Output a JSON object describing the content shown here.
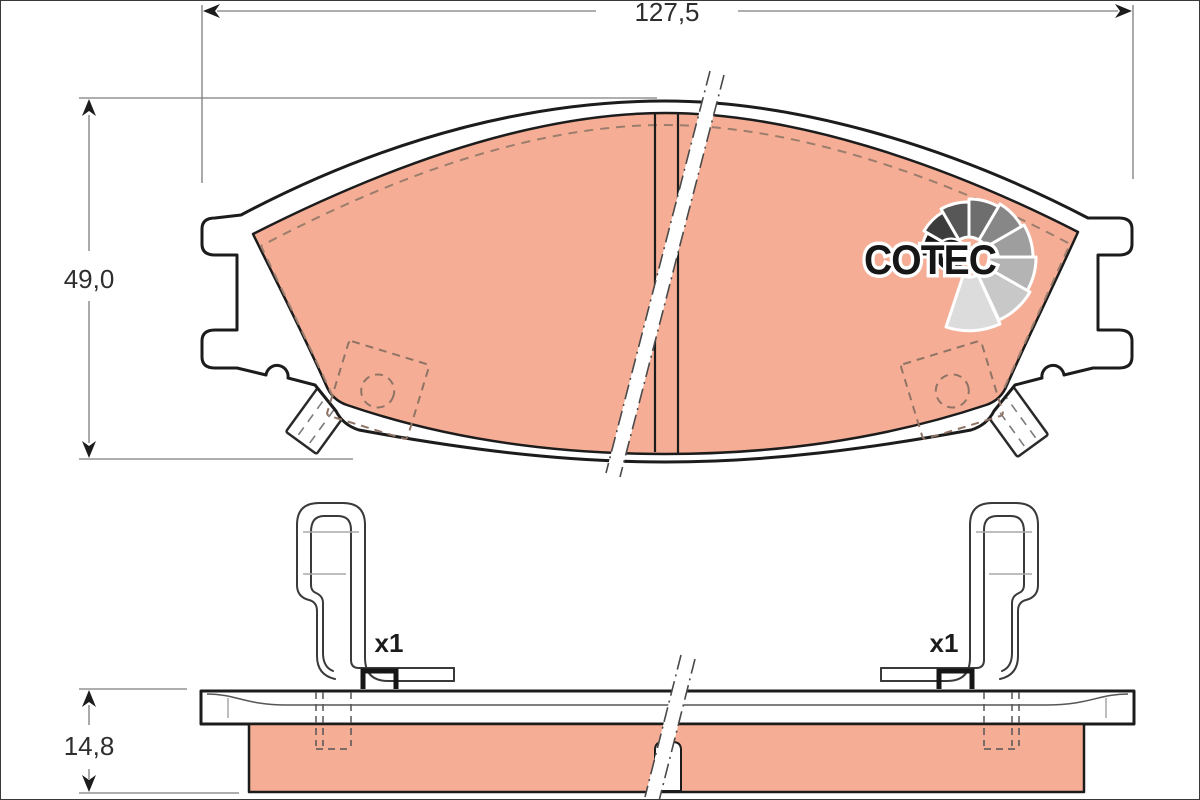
{
  "dimensions": {
    "width": {
      "label": "127,5"
    },
    "height": {
      "label": "49,0"
    },
    "thickness": {
      "label": "14,8"
    }
  },
  "labels": {
    "left_clip_qty": "x1",
    "right_clip_qty": "x1"
  },
  "brand": {
    "logo_text": "COTEC"
  },
  "colors": {
    "friction": "#f5ae95",
    "outline": "#1c1c1c",
    "dim_line": "#7d7d7d",
    "hidden_dash": "#9b7d6d",
    "logo_wedges": [
      "#161616",
      "#3c3c3c",
      "#575757",
      "#6e6e6e",
      "#878787",
      "#9e9e9e",
      "#b4b4b4",
      "#c8c8c8",
      "#dcdcdc"
    ]
  }
}
